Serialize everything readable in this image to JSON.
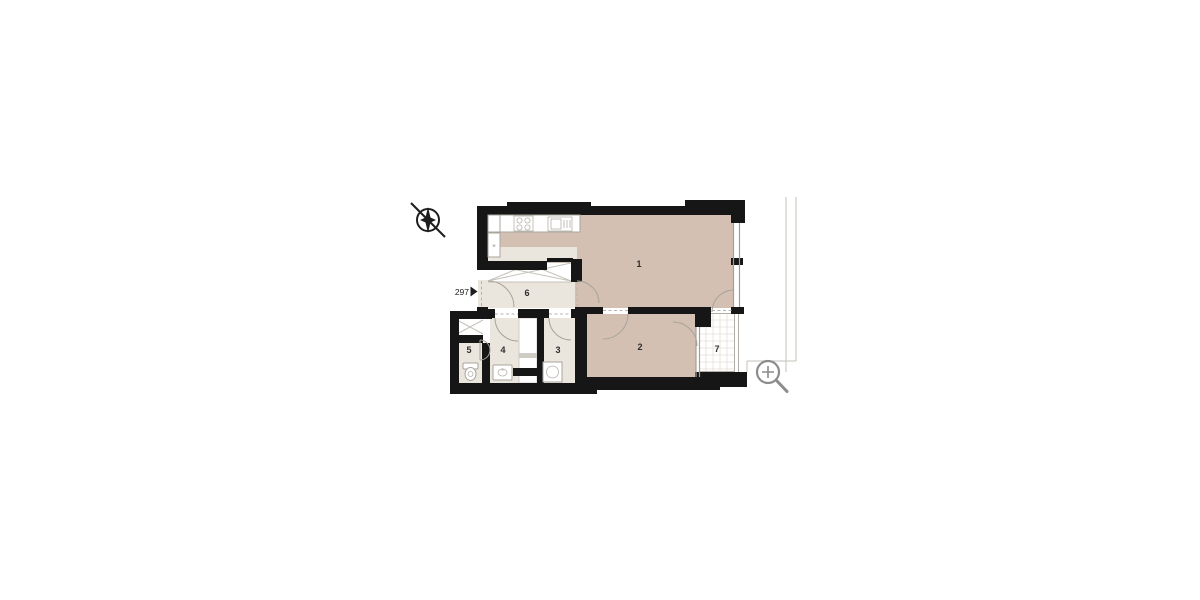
{
  "floor_plan": {
    "unit_label": {
      "number": "297"
    },
    "room_labels": {
      "r1": "1",
      "r2": "2",
      "r3": "3",
      "r4": "4",
      "r5": "5",
      "r6": "6",
      "r7": "7"
    },
    "kitchen_symbol": "*",
    "icons": {
      "north_arrow": "compass-north-arrow-icon",
      "zoom": "magnifier-zoom-icon",
      "entrance_arrow": "entrance-direction-arrow-icon"
    },
    "colors": {
      "wall": "#161616",
      "room_warm": "#d3c0b3",
      "room_light": "#eae5dd",
      "outline_gray": "#b3afa7",
      "icon_gray": "#8c8c8c",
      "label_text": "#2e2e2e"
    }
  }
}
